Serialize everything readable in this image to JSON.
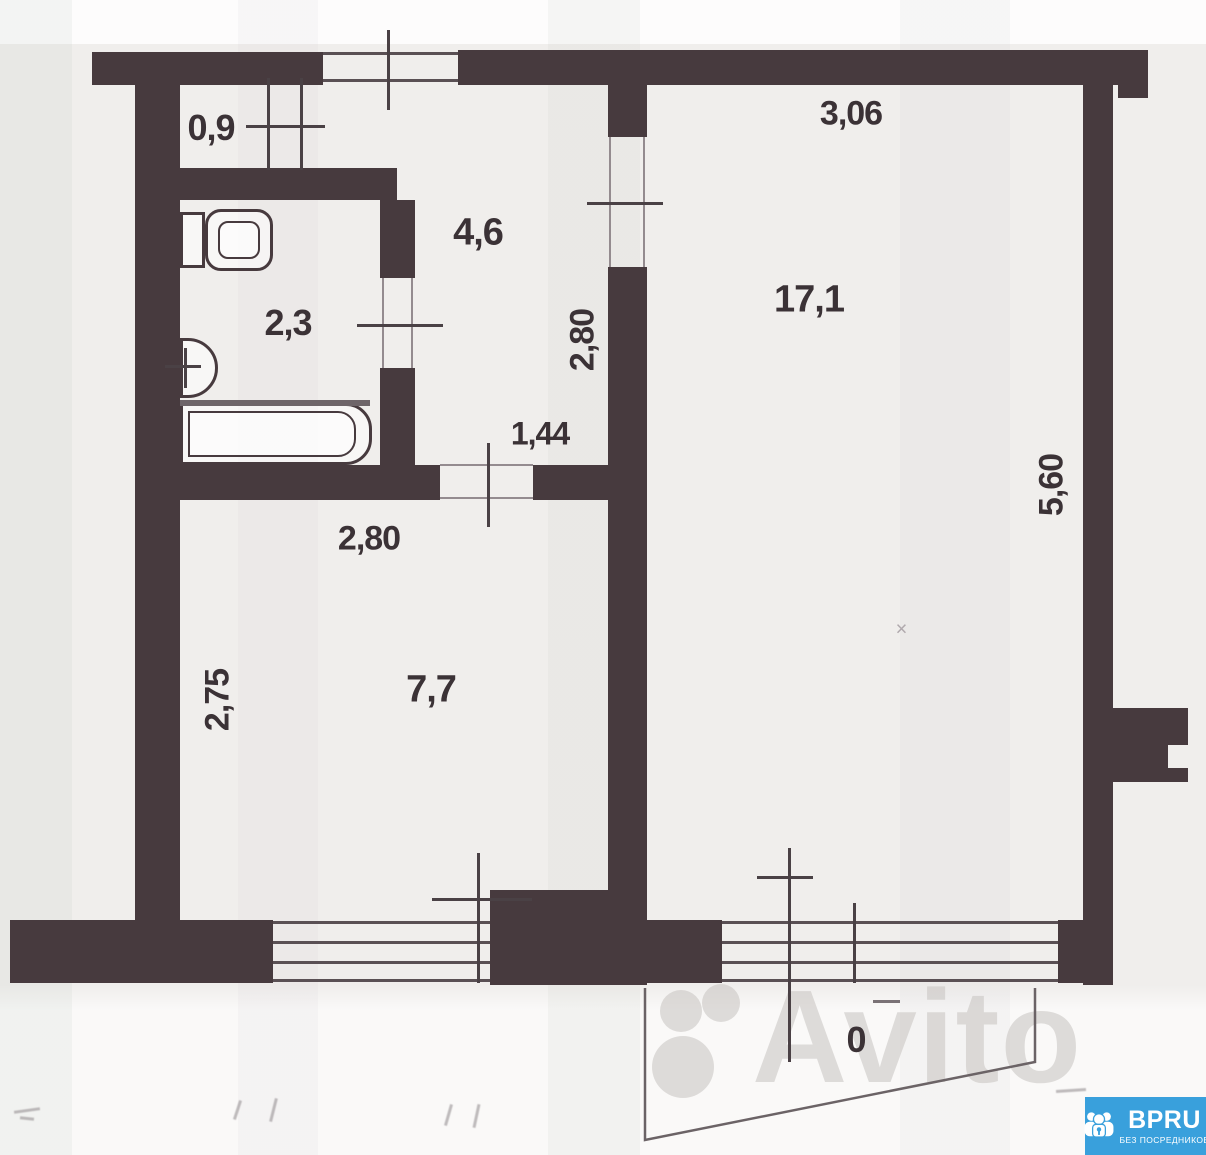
{
  "plan": {
    "dims": {
      "entry_width": "0,9",
      "hall_area": "4,6",
      "bath_area": "2,3",
      "hall_width_v": "2,80",
      "hall_passage": "1,44",
      "kitchen_width": "2,80",
      "kitchen_depth_v": "2,75",
      "kitchen_area": "7,7",
      "room_width": "3,06",
      "room_area": "17,1",
      "room_depth_v": "5,60",
      "obscured_dim": "0",
      "small_mark": "×"
    }
  },
  "watermark": {
    "brand": "Avito"
  },
  "badge": {
    "brand": "BPRU",
    "tagline": "БЕЗ ПОСРЕДНИКОВ"
  },
  "colors": {
    "wall": "#473a3e",
    "paper": "#f0eeec",
    "badge_blue": "#39a0dc",
    "watermark_gray": "#c7c3c0"
  }
}
